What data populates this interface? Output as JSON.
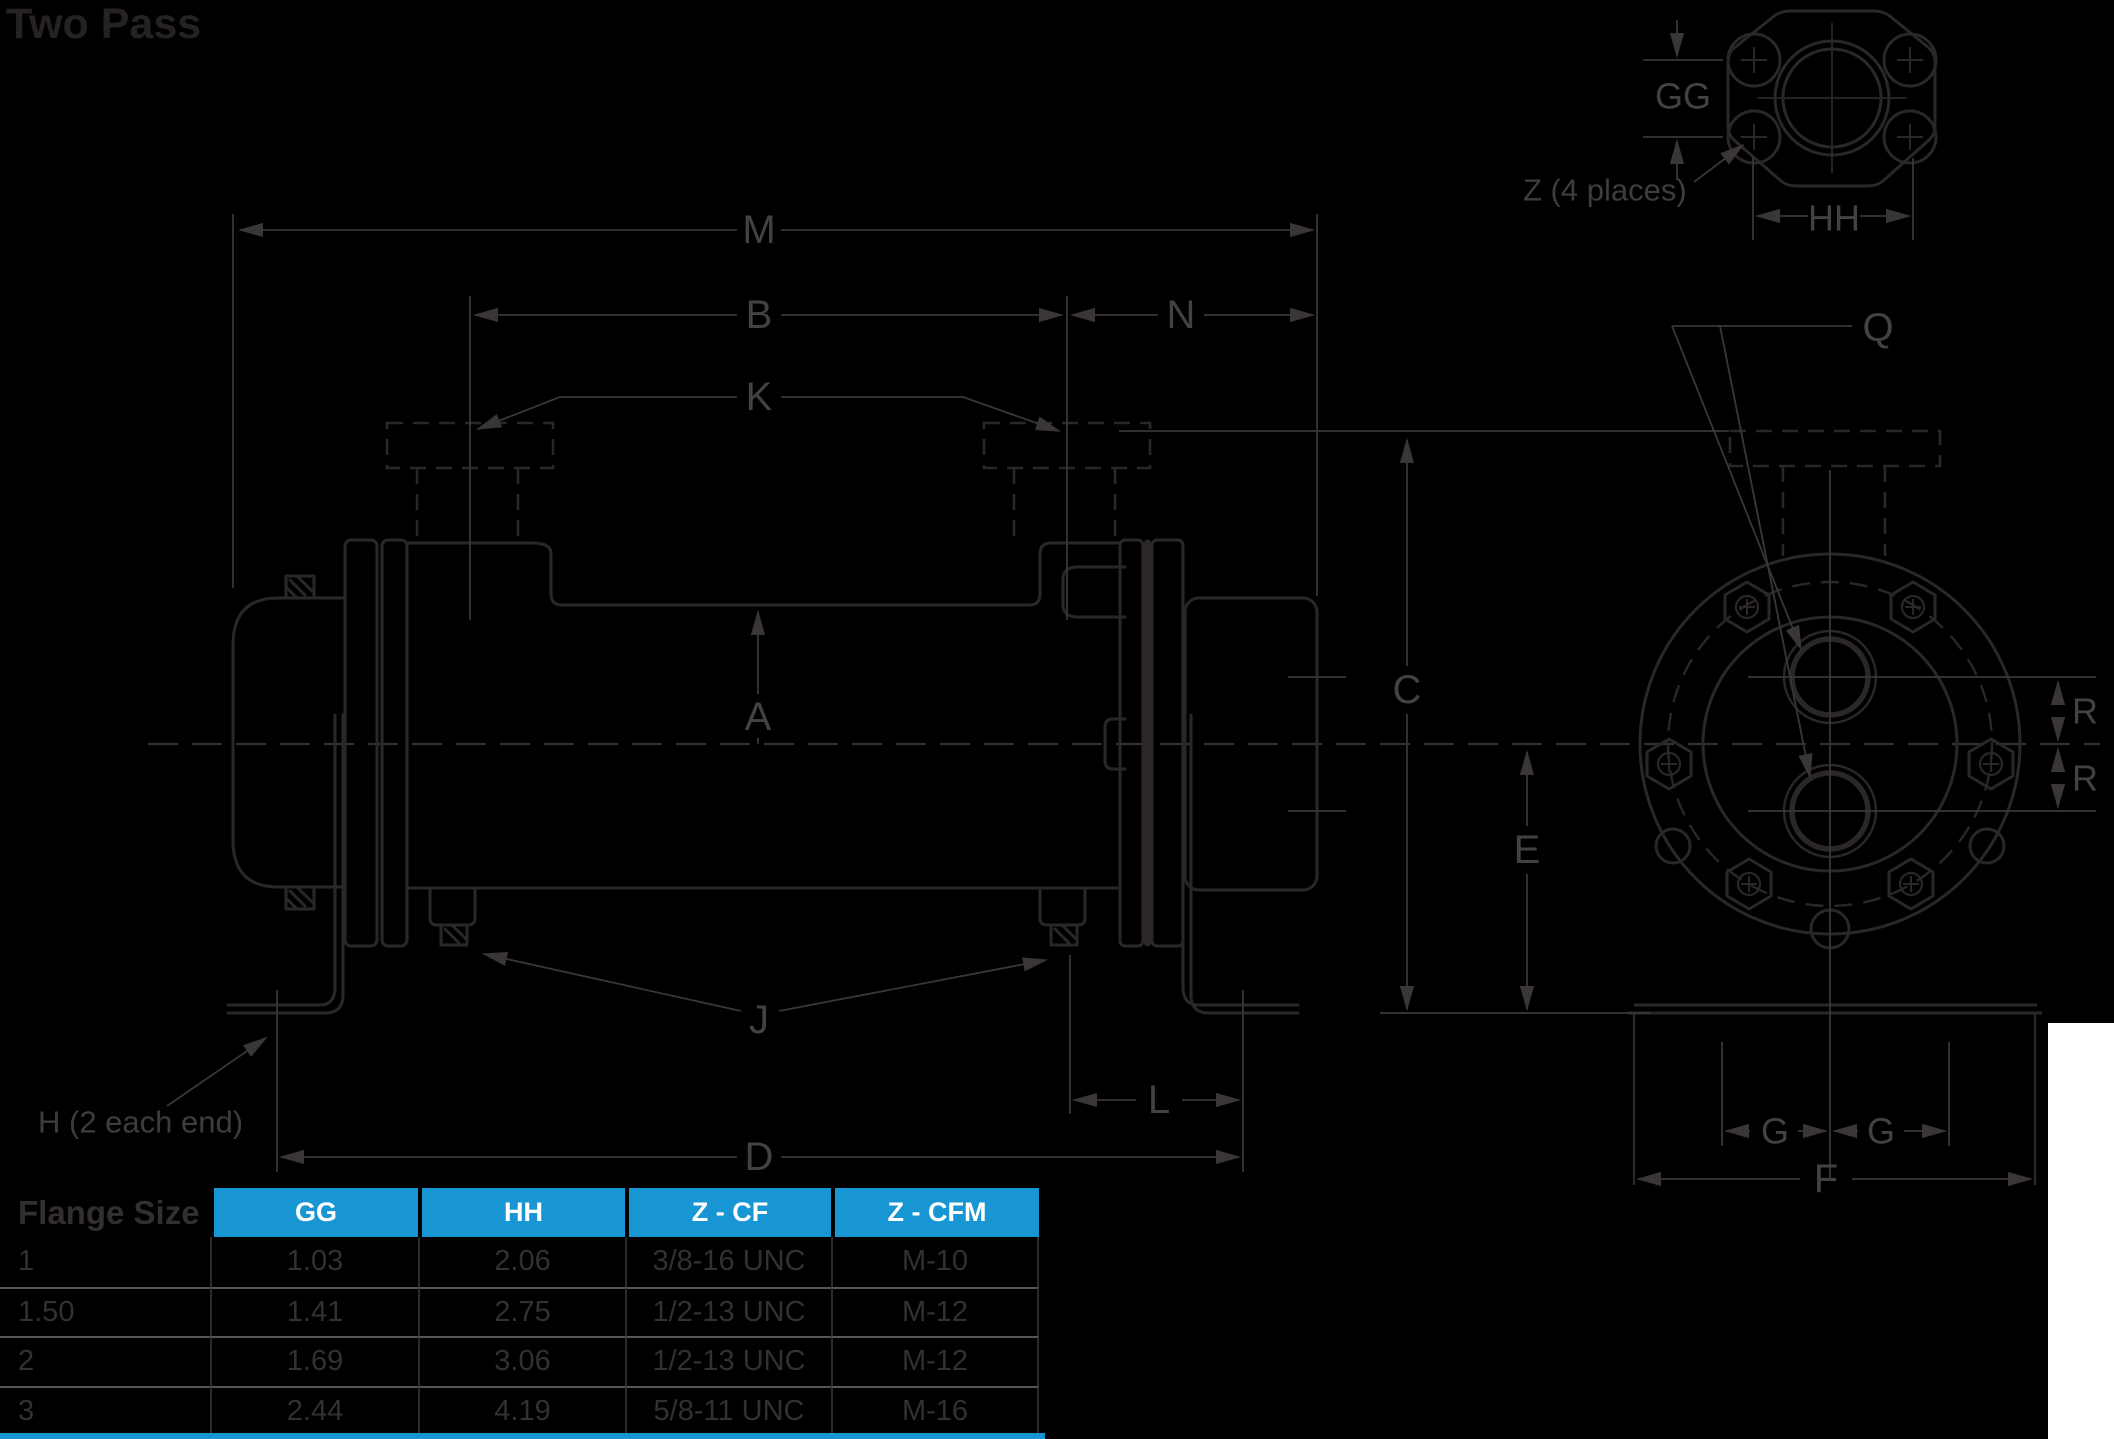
{
  "title": "Two Pass",
  "colors": {
    "background": "#000000",
    "artwork_line": "#2b2728",
    "dimension_line": "#3a3637",
    "label_text": "#454142",
    "accent_blue": "#1896d3",
    "table_header_text": "#ffffff",
    "table_body_text": "#343032",
    "table_row_rule": "#55565a",
    "white_patch": "#ffffff"
  },
  "diagram": {
    "labels": {
      "m": "M",
      "b": "B",
      "n": "N",
      "k": "K",
      "a": "A",
      "c": "C",
      "e": "E",
      "j": "J",
      "l": "L",
      "d": "D",
      "q": "Q",
      "f": "F",
      "g_left": "G",
      "g_right": "G",
      "r_upper": "R",
      "r_lower": "R",
      "gg": "GG",
      "hh": "HH",
      "h_note": "H (2 each end)",
      "z_note": "Z (4 places)"
    }
  },
  "flange_table": {
    "corner_header": "Flange Size",
    "columns": [
      "GG",
      "HH",
      "Z - CF",
      "Z - CFM"
    ],
    "rows": [
      [
        "1",
        "1.03",
        "2.06",
        "3/8-16 UNC",
        "M-10"
      ],
      [
        "1.50",
        "1.41",
        "2.75",
        "1/2-13 UNC",
        "M-12"
      ],
      [
        "2",
        "1.69",
        "3.06",
        "1/2-13 UNC",
        "M-12"
      ],
      [
        "3",
        "2.44",
        "4.19",
        "5/8-11 UNC",
        "M-16"
      ]
    ]
  }
}
